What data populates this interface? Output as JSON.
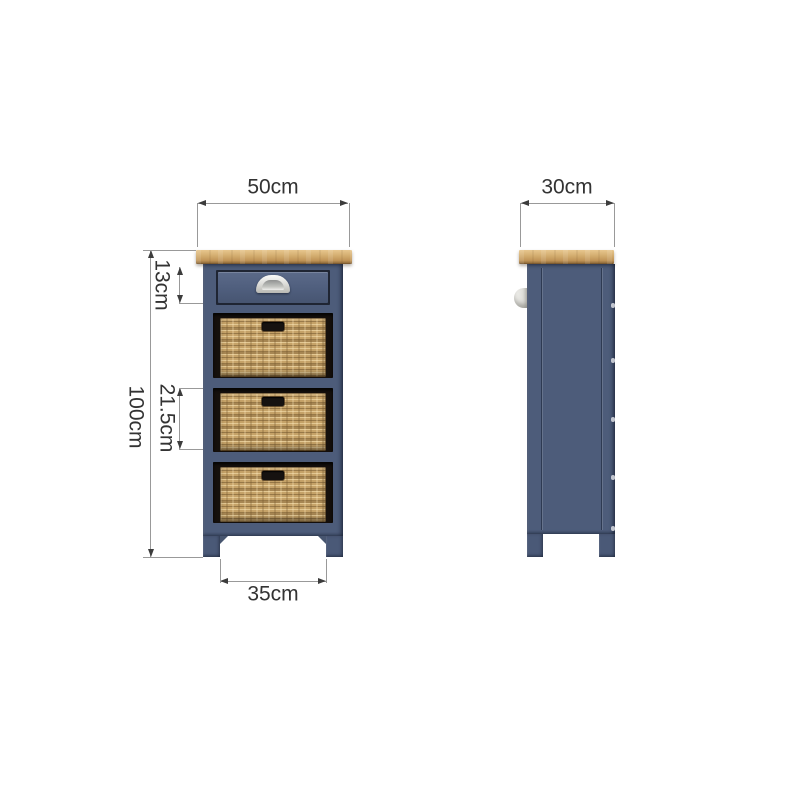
{
  "diagram": {
    "kind": "furniture-dimension-diagram",
    "views": {
      "front": {
        "drawer_count": 1,
        "basket_count": 3
      },
      "side": {
        "basket_count": 0
      }
    },
    "dims": {
      "front_width": "50cm",
      "front_height": "100cm",
      "drawer_height": "13cm",
      "basket_height": "21.5cm",
      "leg_span": "35cm",
      "side_depth": "30cm"
    },
    "colors": {
      "body_blue": "#4d5c7a",
      "oak_top": "#d4ae70",
      "wicker_tan": "#c5a268",
      "opening_dark": "#15100c",
      "handle_silver": "#e9e9e6",
      "dimension_line": "#999999",
      "dimension_arrow": "#3c3c3c",
      "dimension_text": "#333333",
      "background": "#ffffff"
    }
  }
}
